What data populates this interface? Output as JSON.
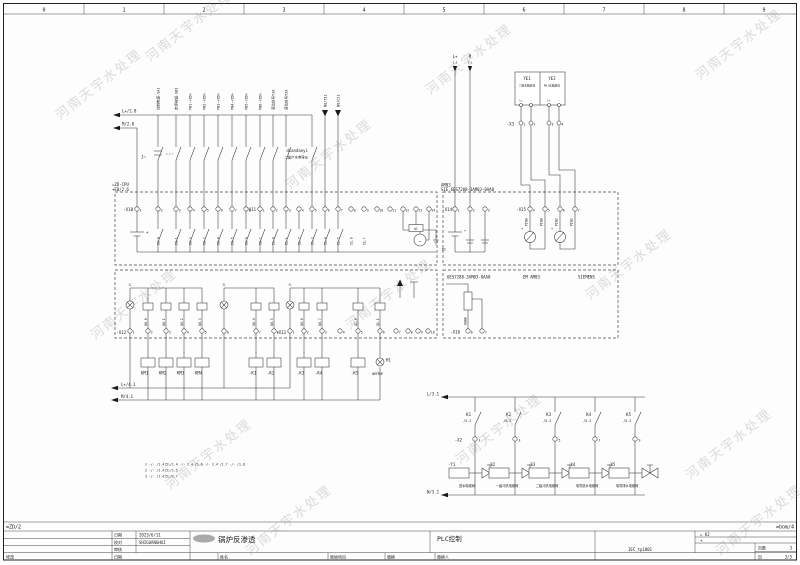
{
  "watermark": "河南天宇水处理",
  "ruler": {
    "numbers": [
      "0",
      "1",
      "2",
      "3",
      "4",
      "5",
      "6",
      "7",
      "8",
      "9"
    ]
  },
  "feeds": {
    "top_l": "L+/2.8",
    "top_m": "M/2.8",
    "mid_l": "L+/4.1",
    "mid_m": "M/4.1"
  },
  "inputs": {
    "labels": [
      "控制电源-SA1",
      "启停按钮-SB1",
      "PB1-<ZD>",
      "PB2-<ZD>",
      "PB3-<ZD>",
      "PB4-<ZD>",
      "PB5-<ZD>",
      "PB6-<ZD>",
      "液位信号T1A",
      "液位信号T2A"
    ],
    "arrow_labels": [
      "NO/T11",
      "NO/C21"
    ],
    "key_label": "J~",
    "note1": "diandaoyi",
    "note2": "二级产水电导仪"
  },
  "cpu": {
    "tag": "=ZD-CPU",
    "tag2": "+EB/2.6",
    "x10": "-X10",
    "x10_nums": [
      "1",
      "2",
      "3",
      "4",
      "5",
      "6",
      "7",
      "8"
    ],
    "x10_wires": [
      "",
      "I0.0",
      "I0.1",
      "I0.2",
      "I0.3",
      "I0.4",
      "I0.5",
      "I0.6"
    ],
    "x11": "-X11",
    "x11_nums": [
      "1",
      "2",
      "3",
      "4",
      "5",
      "6",
      "7",
      "8",
      "9",
      "10",
      "11",
      "12",
      "13",
      "14"
    ],
    "x11_wires": [
      "I0.7",
      "I1.0",
      "I1.1",
      "I1.2",
      "I1.3",
      "I1.4",
      "I1.5",
      "I1.6",
      "I1.7",
      "",
      "",
      "",
      "",
      ""
    ],
    "plus": "+",
    "ac": "AC",
    "tilde": "~"
  },
  "am03": {
    "tag": "AM03",
    "order": "SIE.6ES7288-3AM03-0AA0",
    "x14": "-X14",
    "x14_nums": [
      "1",
      "2",
      "3"
    ],
    "x15": "-X15",
    "x15_nums": [
      "4",
      "5",
      "6",
      "7"
    ],
    "piw_wires": [
      "PIW0",
      "PIW0",
      "PIW2",
      "PIW2"
    ],
    "dc": "DC",
    "plus": "+",
    "plus2": "+",
    "plus3": "+",
    "em1": "6ES7288-3AM03-0AA0",
    "em2": "EM AM03",
    "em3": "SIEMENS",
    "x16": "-X16",
    "x16_nums": [
      "6",
      "7"
    ],
    "aq_wire": "AQW0"
  },
  "sensors": {
    "l_label": "L+",
    "l_ref": "3.1",
    "m_label": "M",
    "m_ref": "3.1",
    "ye1": "YE1",
    "ye1_desc": "二级水箱液位",
    "ye2": "YE2",
    "ye2_desc": "RO1水箱液位",
    "terms": [
      "L+",
      "-",
      "L+",
      "-"
    ],
    "x3": "-X3",
    "x3_nums": [
      "1",
      "2",
      "3",
      "4"
    ]
  },
  "outputs": {
    "x12": "-X12",
    "x12_nums": [
      "1",
      "2",
      "3",
      "4",
      "5",
      "6",
      "7",
      "8"
    ],
    "x12_wires": [
      "",
      "Q0.0",
      "Q0.1",
      "Q0.2",
      "Q0.3",
      "",
      "Q0.4",
      "Q0.5"
    ],
    "x13": "-X13",
    "x13_nums": [
      "1",
      "2",
      "3",
      "4",
      "5",
      "6",
      "7",
      "8",
      "9",
      "10"
    ],
    "x13_wires": [
      "",
      "Q0.6",
      "Q0.7",
      "",
      "Q1.0",
      "Q1.1",
      "",
      "",
      "",
      ""
    ],
    "groups": [
      "1L",
      "2L",
      "3L"
    ],
    "coils": [
      "KM1",
      "KM2",
      "KM3",
      "KM4",
      "-K1",
      "-K2",
      "-K3",
      "-K4",
      "-K5"
    ],
    "h1": "H1",
    "h1_desc": "运行指示"
  },
  "valves": {
    "bus_l": "L/3.1",
    "bus_n": "N/3.1",
    "x2": "-X2",
    "x2_nums": [
      "1",
      "3",
      "5",
      "7",
      "9"
    ],
    "contact_names": [
      "K1",
      "K2",
      "K3",
      "K4",
      "K5"
    ],
    "contact_refs": [
      "/5.2",
      "/5.2",
      "/5.3",
      "/5.3",
      "/5.3"
    ],
    "tags": [
      "-Y1",
      "-Y2",
      "-Y3",
      "-Y4",
      "-Y5"
    ],
    "descs": [
      "进水电磁阀",
      "一级冲洗电磁阀",
      "二级冲洗电磁阀",
      "电导进水电磁阀",
      "电导排水电磁阀"
    ]
  },
  "legend": {
    "lines": [
      "1 -/-  /1.4(5)/1.4      -/-  2.4 /1.6      -/-  2.4 /1.7      -/-  /1.8",
      "2 -/-  /1.4(5)/1.5",
      "3 -/-  /1.4(5)/1.7"
    ]
  },
  "titleblock": {
    "ref_left": "=ZD/2",
    "ref_right": "=bom/4",
    "date_label": "日期",
    "date": "2023/6/11",
    "check_label": "校对",
    "check": "SHIGUANGHUI",
    "audit_label": "审核",
    "rev_label": "修改",
    "revdate_label": "日期",
    "name_label": "姓名",
    "orig_label": "原始项目",
    "repl_label": "替换",
    "replby_label": "替换人",
    "title": "锅炉反渗透",
    "subtitle": "PLC控制",
    "doc": "IEC_tp1001",
    "loc1": "= K2",
    "loc2": "+",
    "pages_label": "页数",
    "pages": "3",
    "page_label": "页",
    "page": "3/5"
  }
}
